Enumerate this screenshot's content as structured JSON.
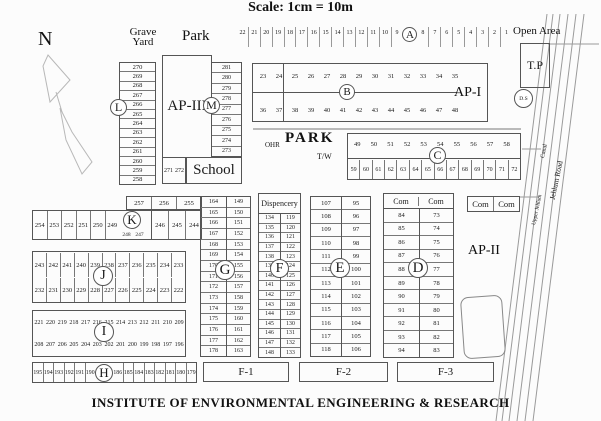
{
  "scale_text": "Scale:   1cm = 10m",
  "title": "INSTITUTE OF ENVIRONMENTAL  ENGINEERING  & RESEARCH",
  "compass": "N",
  "top": {
    "grave_yard_line1": "Grave",
    "grave_yard_line2": "Yard",
    "park": "Park",
    "open_area": "Open Area",
    "tp": "T.P",
    "ds": "D.S"
  },
  "areas": {
    "ap3": "AP-III",
    "ap1": "AP-I",
    "ap2": "AP-II",
    "school": "School",
    "park_mid": "PARK",
    "ohr": "OHR",
    "tw": "T/W",
    "dispensary": "Dispencery",
    "f1": "F-1",
    "f2": "F-2",
    "f3": "F-3"
  },
  "road": {
    "road_label": "Jehlum Road",
    "canal_label": "Canal",
    "upper_label": "Upper Jehlum"
  },
  "blocks": {
    "A": {
      "letter": "A",
      "before": [
        "22",
        "21",
        "20",
        "19",
        "18",
        "17",
        "16",
        "15",
        "14",
        "13",
        "12",
        "11",
        "10",
        "9"
      ],
      "after": [
        "8",
        "7",
        "6",
        "5",
        "4",
        "3",
        "2",
        "1"
      ]
    },
    "B": {
      "letter": "B",
      "top": [
        "23",
        "24",
        "25",
        "26",
        "27",
        "28",
        "29",
        "30",
        "31",
        "32",
        "33",
        "34",
        "35"
      ],
      "bottom": [
        "36",
        "37",
        "38",
        "39",
        "40",
        "41",
        "42",
        "43",
        "44",
        "45",
        "46",
        "47",
        "48"
      ]
    },
    "C": {
      "letter": "C",
      "top": [
        "49",
        "50",
        "51",
        "52",
        "53",
        "54",
        "55",
        "56",
        "57",
        "58"
      ],
      "bottom": [
        "59",
        "60",
        "61",
        "62",
        "63",
        "64",
        "65",
        "66",
        "67",
        "68",
        "69",
        "70",
        "71",
        "72"
      ]
    },
    "D": {
      "letter": "D",
      "headers": [
        "Com",
        "Com"
      ],
      "left": [
        "84",
        "85",
        "86",
        "87",
        "88",
        "89",
        "90",
        "91",
        "92",
        "93",
        "94"
      ],
      "right": [
        "73",
        "74",
        "75",
        "76",
        "77",
        "78",
        "79",
        "80",
        "81",
        "82",
        "83"
      ]
    },
    "E": {
      "letter": "E",
      "left": [
        "107",
        "108",
        "109",
        "110",
        "111",
        "112",
        "113",
        "114",
        "115",
        "116",
        "117",
        "118"
      ],
      "right": [
        "95",
        "96",
        "97",
        "98",
        "99",
        "100",
        "101",
        "102",
        "103",
        "104",
        "105",
        "106"
      ]
    },
    "F": {
      "letter": "F",
      "left": [
        "134",
        "135",
        "136",
        "137",
        "138",
        "139",
        "140",
        "141",
        "142",
        "143",
        "144",
        "145",
        "146",
        "147",
        "148"
      ],
      "right": [
        "119",
        "120",
        "121",
        "122",
        "123",
        "124",
        "125",
        "126",
        "127",
        "128",
        "129",
        "130",
        "131",
        "132",
        "133"
      ]
    },
    "G": {
      "letter": "G",
      "left": [
        "164",
        "165",
        "166",
        "167",
        "168",
        "169",
        "170",
        "171",
        "172",
        "173",
        "174",
        "175",
        "176",
        "177",
        "178"
      ],
      "right": [
        "149",
        "150",
        "151",
        "152",
        "153",
        "154",
        "155",
        "156",
        "157",
        "158",
        "159",
        "160",
        "161",
        "162",
        "163"
      ]
    },
    "H": {
      "letter": "H",
      "left": [
        "195",
        "194",
        "193",
        "192",
        "191",
        "190"
      ],
      "right": [
        "186",
        "185",
        "184",
        "183",
        "182",
        "181",
        "180",
        "179"
      ]
    },
    "I": {
      "letter": "I",
      "top": [
        "221",
        "220",
        "219",
        "218",
        "217",
        "216",
        "215",
        "214",
        "213",
        "212",
        "211",
        "210",
        "209"
      ],
      "bottom": [
        "208",
        "207",
        "206",
        "205",
        "204",
        "203",
        "202",
        "201",
        "200",
        "199",
        "198",
        "197",
        "196"
      ]
    },
    "J": {
      "letter": "J",
      "top": [
        "243",
        "242",
        "241",
        "240",
        "239",
        "238",
        "237",
        "236",
        "235",
        "234",
        "233"
      ],
      "bottom": [
        "232",
        "231",
        "230",
        "229",
        "228",
        "227",
        "226",
        "225",
        "224",
        "223",
        "222"
      ]
    },
    "K": {
      "letter": "K",
      "strip": [
        "257",
        "256",
        "255"
      ],
      "left": [
        "254",
        "253",
        "252",
        "251",
        "250",
        "249"
      ],
      "under": [
        "248",
        "247"
      ],
      "right": [
        "246",
        "245",
        "244"
      ]
    },
    "L": {
      "letter": "L",
      "col": [
        "270",
        "269",
        "268",
        "267",
        "266",
        "265",
        "264",
        "263",
        "262",
        "261",
        "260",
        "259",
        "258"
      ]
    },
    "M": {
      "letter": "M",
      "col": [
        "281",
        "280",
        "279",
        "278",
        "277",
        "276",
        "275",
        "274",
        "273"
      ]
    },
    "extra271": [
      "271",
      "272"
    ],
    "com_pair": [
      "Com",
      "Com"
    ]
  }
}
